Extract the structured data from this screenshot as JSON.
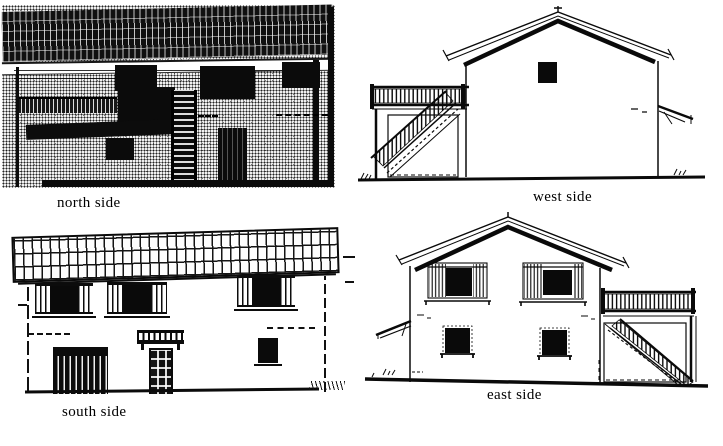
{
  "figure": {
    "panels": [
      {
        "id": "north",
        "label": "north side"
      },
      {
        "id": "west",
        "label": "west side"
      },
      {
        "id": "south",
        "label": "south side"
      },
      {
        "id": "east",
        "label": "east side"
      }
    ]
  },
  "colors": {
    "ink": "#0a0a0a",
    "paper": "#ffffff"
  }
}
